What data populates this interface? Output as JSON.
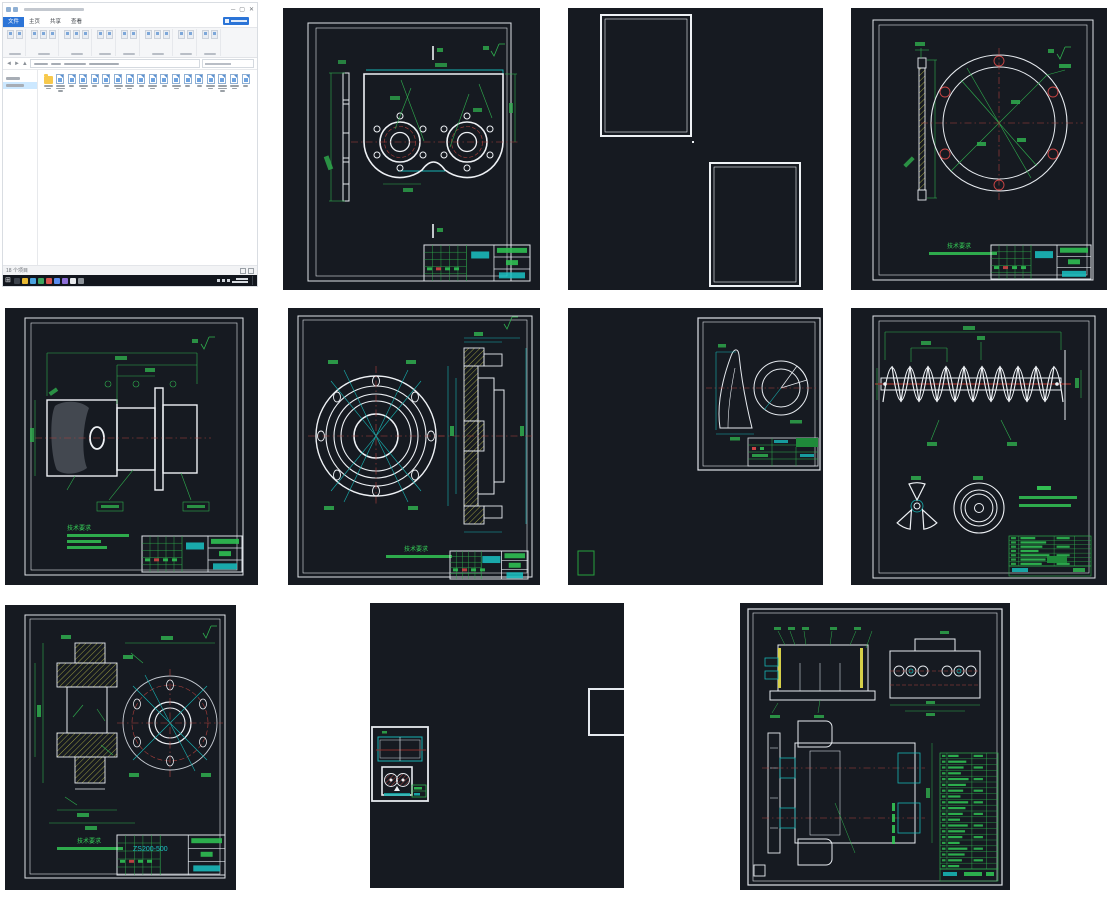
{
  "page": {
    "background": "#ffffff"
  },
  "colors": {
    "cad_bg": "#161a21",
    "line_white": "#e6eaef",
    "dim_green": "#2fae4e",
    "note_green": "#35d058",
    "teal": "#17b3b3",
    "center_red": "#b0403c",
    "hatch_olive": "#9a9a40",
    "highlight_yellow": "#d6d049",
    "explorer_accent": "#2b74d7",
    "taskbar_bg": "#12161d"
  },
  "explorer": {
    "ribbon_tabs": [
      {
        "label": "文件",
        "active": true
      },
      {
        "label": "主页",
        "active": false
      },
      {
        "label": "共享",
        "active": false
      },
      {
        "label": "查看",
        "active": false
      }
    ],
    "ribbon_groups": [
      2,
      3,
      3,
      2,
      2,
      3,
      2,
      2
    ],
    "status_text": "18 个项目",
    "file_label_lines": [
      2,
      3,
      1,
      2,
      1,
      1,
      2,
      2,
      1,
      2,
      1,
      2,
      1,
      1,
      2,
      3,
      2,
      1
    ]
  },
  "taskbar": {
    "icon_colors": [
      "#3d434c",
      "#e8b931",
      "#4aa3e0",
      "#3ba55d",
      "#d9534f",
      "#5b8def",
      "#8e6fd8",
      "#e8eaed",
      "#8a9097"
    ]
  },
  "drawings": {
    "notes_heading": "技术要求",
    "cad8_number": "ZS200-500",
    "bom_rows": 20
  }
}
